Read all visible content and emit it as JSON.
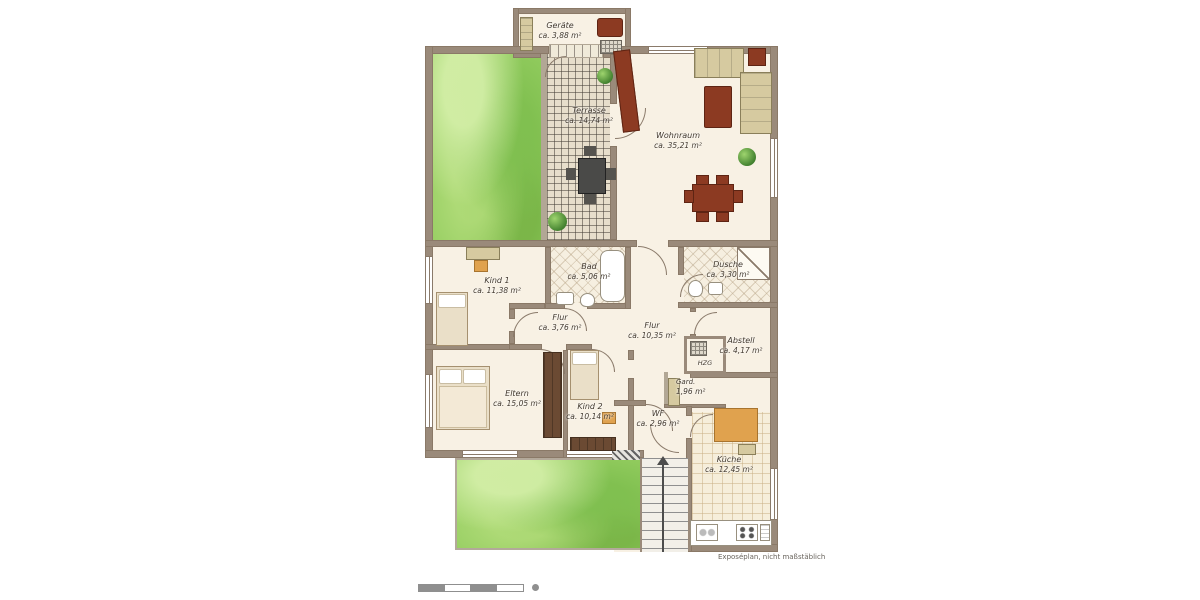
{
  "plan": {
    "rooms": [
      {
        "name": "Geräte",
        "area": "ca. 3,88 m²"
      },
      {
        "name": "Terrasse",
        "area": "ca. 14,74 m²"
      },
      {
        "name": "Wohnraum",
        "area": "ca. 35,21 m²"
      },
      {
        "name": "Kind 1",
        "area": "ca. 11,38 m²"
      },
      {
        "name": "Bad",
        "area": "ca. 5,06 m²"
      },
      {
        "name": "Dusche",
        "area": "ca. 3,30 m²"
      },
      {
        "name": "Flur",
        "area": "ca. 3,76 m²"
      },
      {
        "name": "Flur",
        "area": "ca. 10,35 m²"
      },
      {
        "name": "Abstell",
        "area": "ca. 4,17 m²"
      },
      {
        "name": "HZG",
        "area": ""
      },
      {
        "name": "Gard.",
        "area": "1,96 m²"
      },
      {
        "name": "Eltern",
        "area": "ca. 15,05 m²"
      },
      {
        "name": "Kind 2",
        "area": "ca. 10,14 m²"
      },
      {
        "name": "WF",
        "area": "ca. 2,96 m²"
      },
      {
        "name": "Küche",
        "area": "ca. 12,45 m²"
      }
    ],
    "footer_note": "Exposéplan, nicht maßstäblich",
    "colors": {
      "wall": "#9a8a7a",
      "floor": "#f8f1e4",
      "garden_green": "#94cd60",
      "furniture_red": "#8c3a22",
      "furniture_tan": "#d6caa0",
      "accent_orange": "#e0a24e"
    }
  }
}
